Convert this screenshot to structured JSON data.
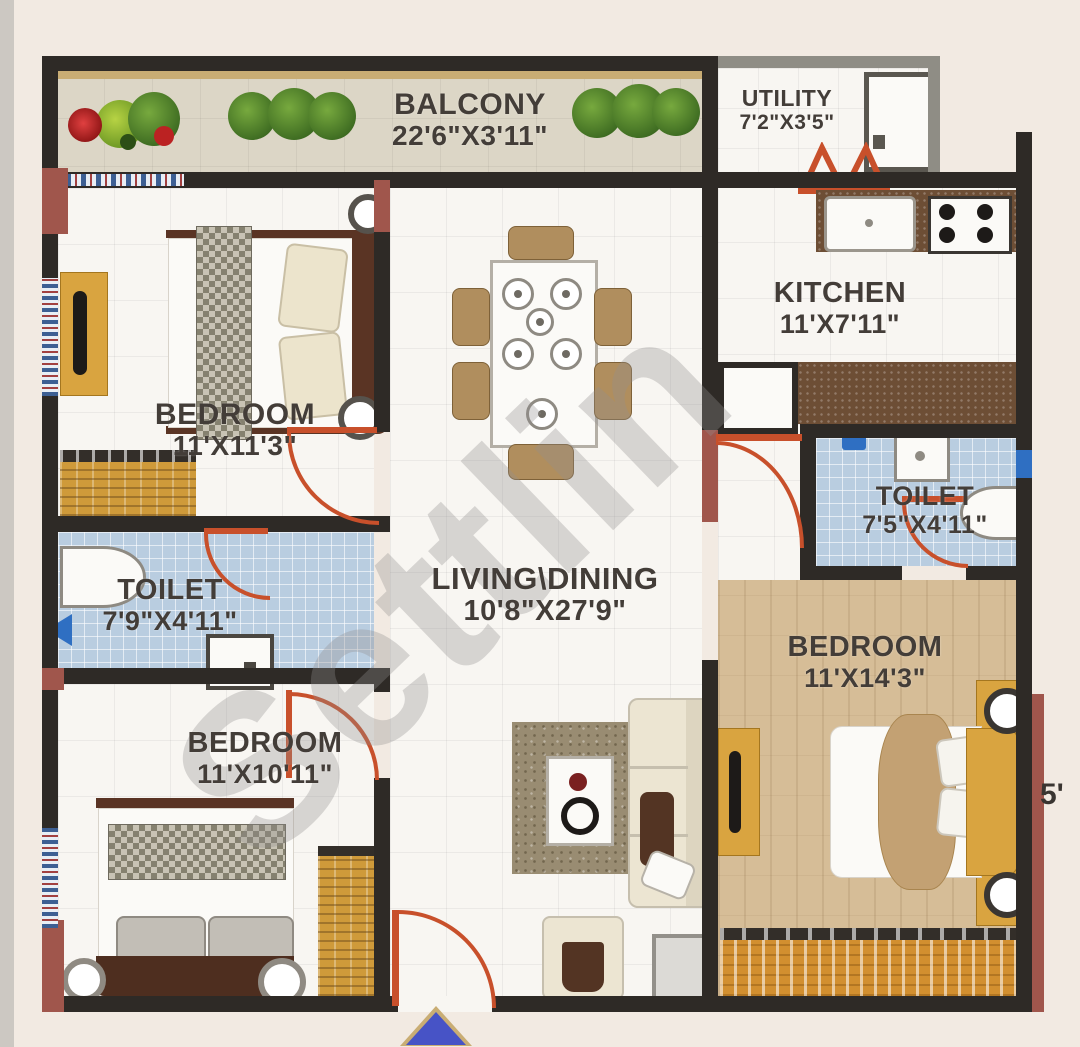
{
  "watermark": "Settlin",
  "partial_dim": "5'",
  "rooms": {
    "balcony": {
      "name": "BALCONY",
      "dims": "22'6\"X3'11\""
    },
    "utility": {
      "name": "UTILITY",
      "dims": "7'2\"X3'5\""
    },
    "kitchen": {
      "name": "KITCHEN",
      "dims": "11'X7'11\""
    },
    "bedroom_top_left": {
      "name": "BEDROOM",
      "dims": "11'X11'3\""
    },
    "toilet_left": {
      "name": "TOILET",
      "dims": "7'9\"X4'11\""
    },
    "living_dining": {
      "name": "LIVING\\DINING",
      "dims": "10'8\"X27'9\""
    },
    "toilet_right": {
      "name": "TOILET",
      "dims": "7'5\"X4'11\""
    },
    "bedroom_right": {
      "name": "BEDROOM",
      "dims": "11'X14'3\""
    },
    "bedroom_bottom_left": {
      "name": "BEDROOM",
      "dims": "11'X10'11\""
    }
  },
  "colors": {
    "wall": "#2e2a26",
    "wall_accent": "#a0564c",
    "door": "#c8502b",
    "tile_blue": "#b9cde0",
    "wood_floor": "#d6bd97",
    "balcony_floor": "#dcd6c6",
    "counter": "#6d4e35",
    "gold": "#d9a440",
    "background": "#f2eae2",
    "entry_arrow": "#4753c6"
  },
  "icons": {
    "bush-icon": "green circle shrub",
    "flower-icon": "red/green flower cluster",
    "washing-machine-icon": "white box with drum",
    "sink-icon": "white basin",
    "stove-icon": "4 burner hob",
    "toilet-bowl-icon": "white oval wc",
    "shower-icon": "square shower tray",
    "entrance-arrow-icon": "blue up triangle"
  }
}
